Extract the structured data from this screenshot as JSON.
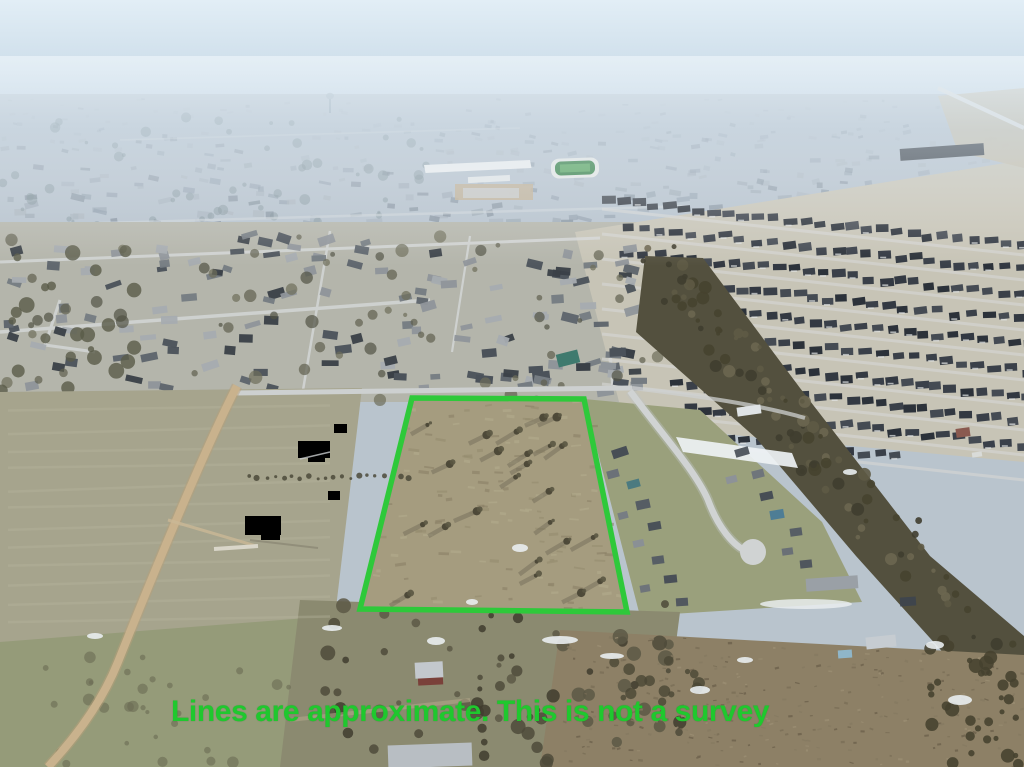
{
  "photo": {
    "kind": "aerial-drone-photograph",
    "description": "Winter aerial view of a vacant tree-dotted land parcel outlined in green, bordered by rural pasture, a dirt road, a small residential street with cul-de-sac, and large suburban subdivisions receding into haze"
  },
  "overlay": {
    "disclaimer_text": "Lines are approximate. This is not a survey",
    "line_color": "#2ec93a",
    "text_color": "#1fc82e",
    "boundary_points": "412,398 584,399 627,612 360,609",
    "boundary_stroke_width": "5.5"
  }
}
